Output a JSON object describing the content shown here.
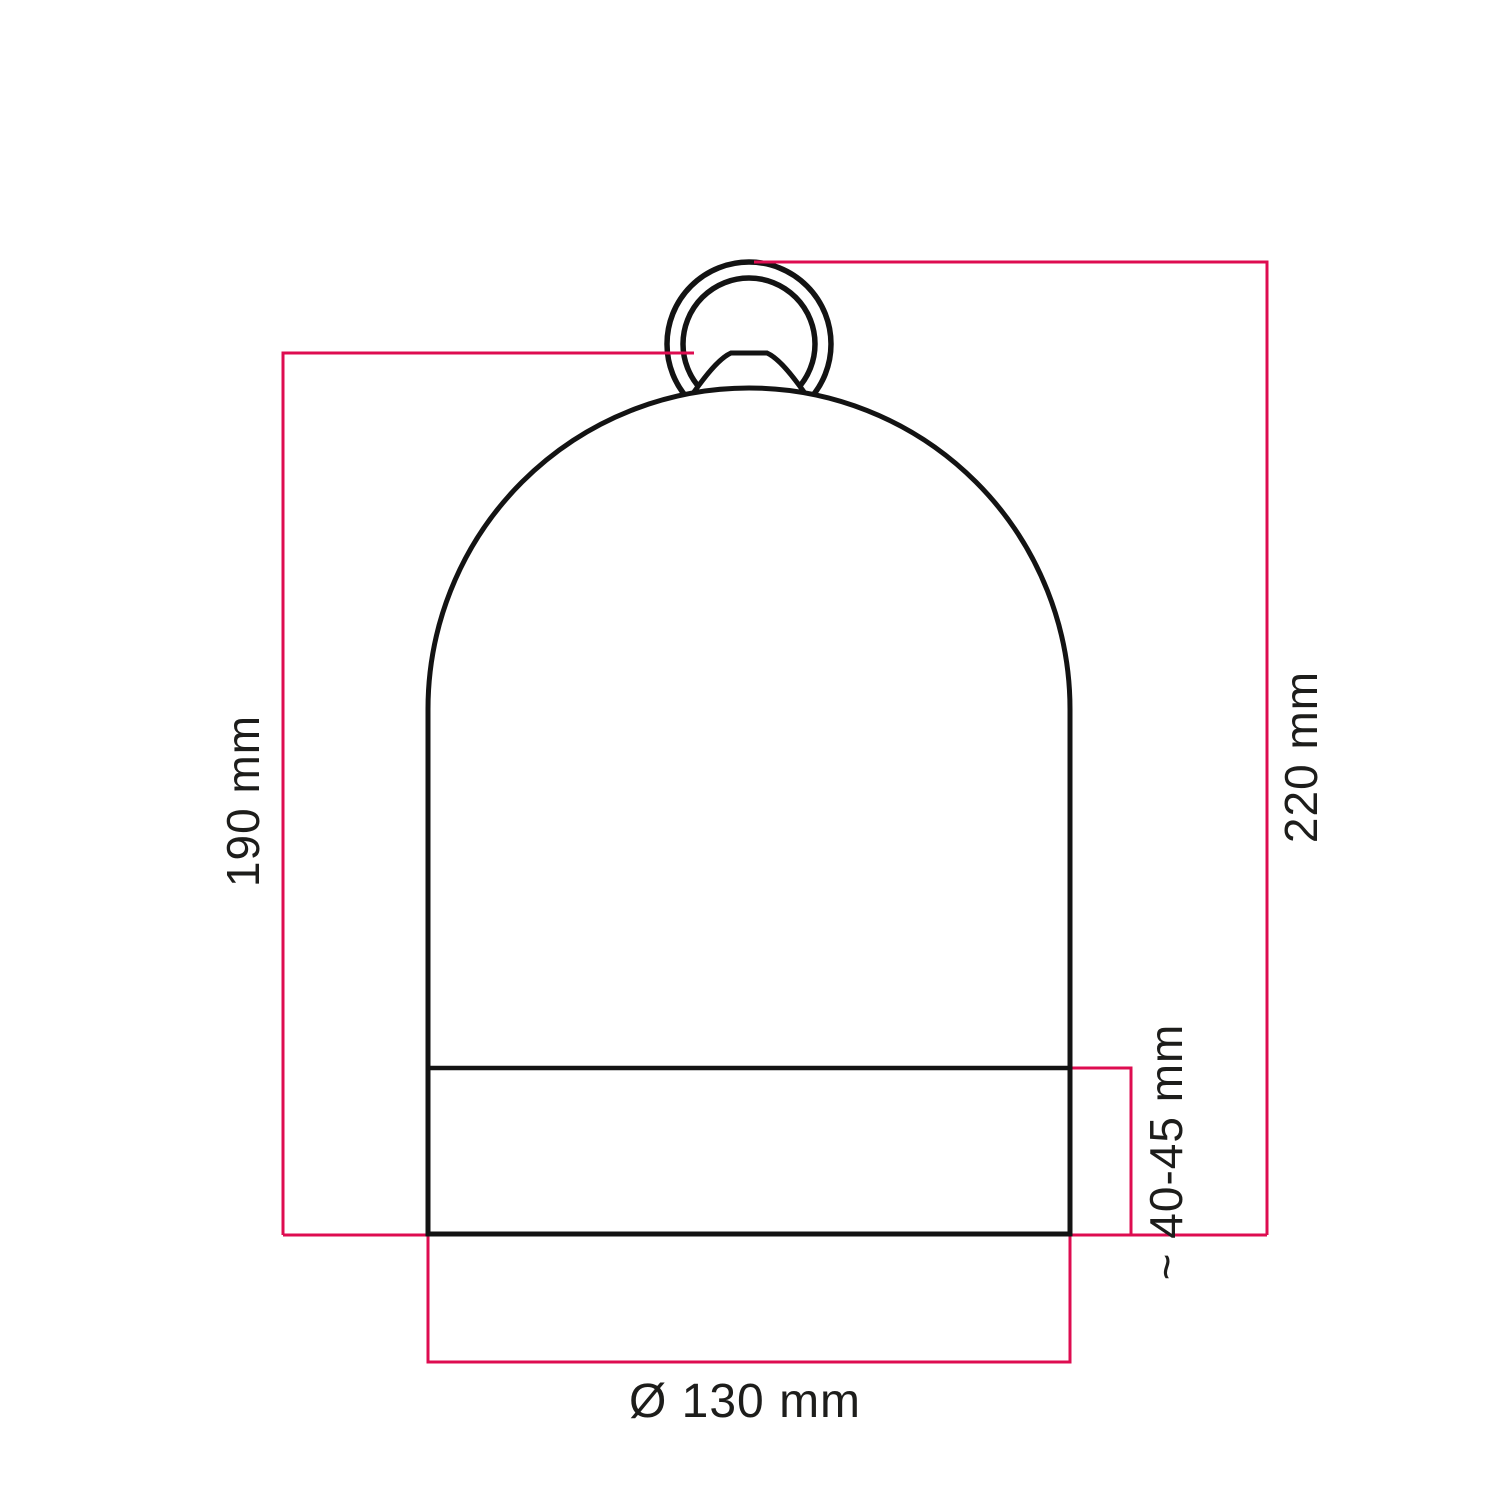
{
  "diagram": {
    "labels": {
      "left_height": "190 mm",
      "total_height": "220 mm",
      "band_height": "~ 40-45 mm",
      "diameter": "Ø 130 mm"
    },
    "colors": {
      "dimension_line": "#de0c50",
      "outline": "#131313",
      "label_text": "#1d1d1b",
      "background": "#ffffff"
    }
  }
}
